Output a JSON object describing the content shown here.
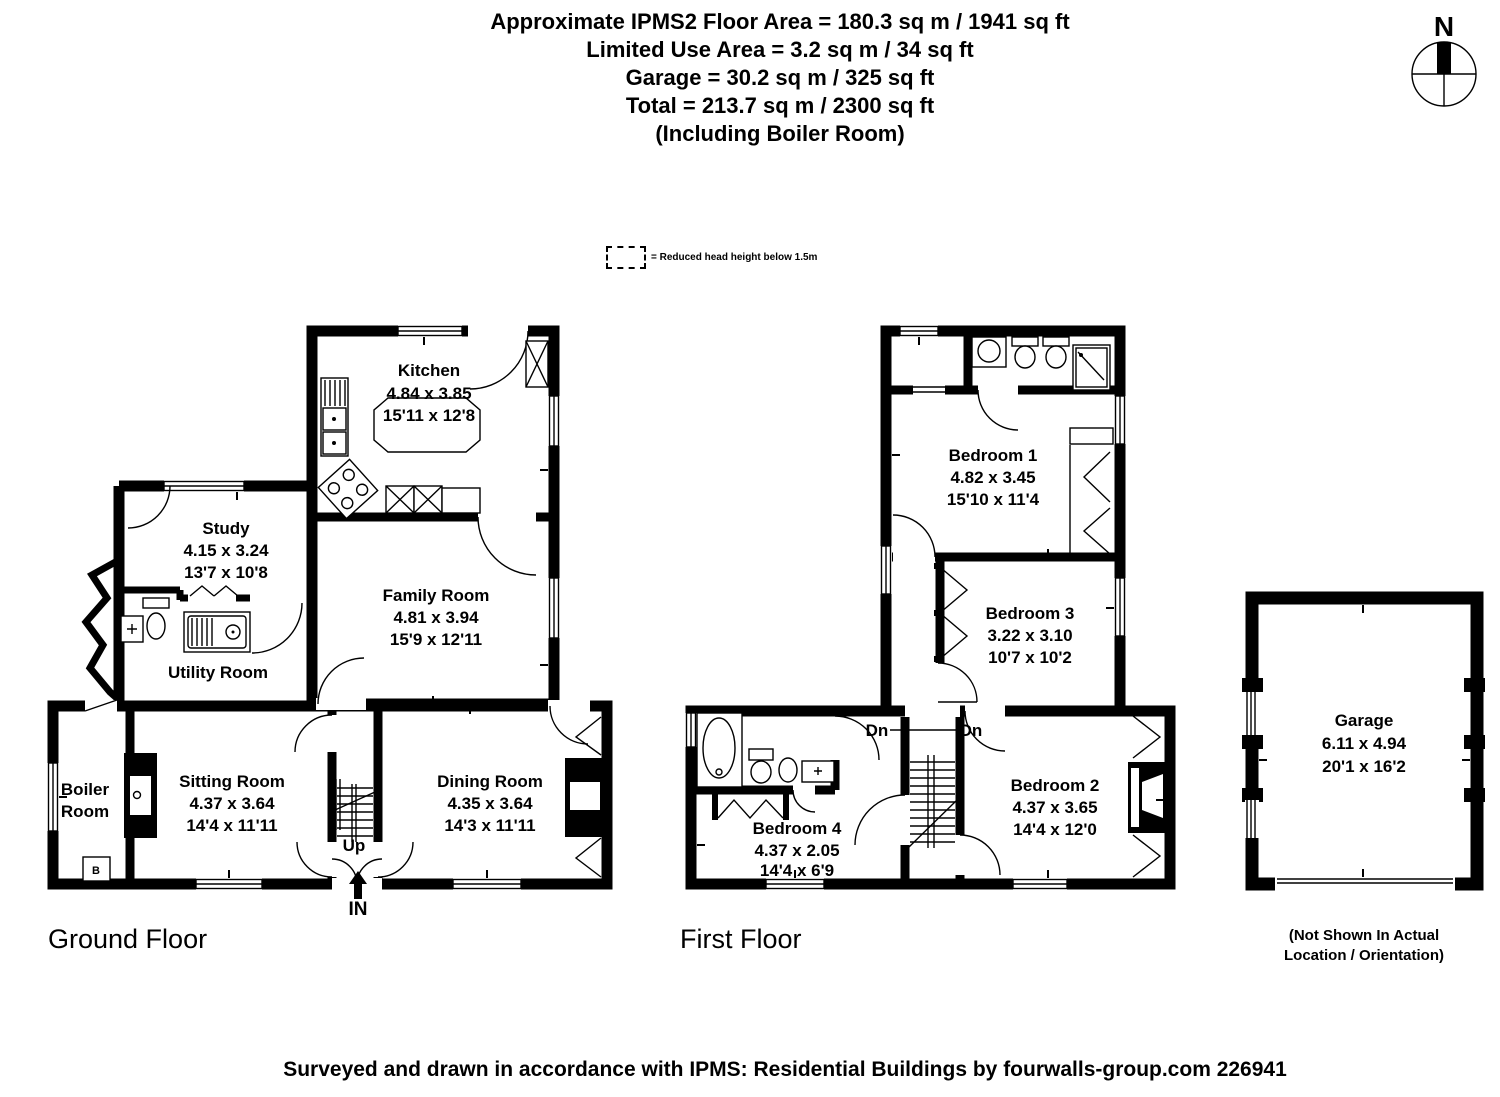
{
  "header": {
    "lines": [
      "Approximate IPMS2 Floor Area = 180.3 sq m / 1941 sq ft",
      "Limited Use Area = 3.2 sq m / 34 sq ft",
      "Garage = 30.2 sq m / 325 sq ft",
      "Total = 213.7 sq m / 2300 sq ft",
      "(Including Boiler Room)"
    ]
  },
  "legend": {
    "label": "= Reduced head height below 1.5m"
  },
  "compass": {
    "north_label": "N"
  },
  "ground_floor": {
    "caption": "Ground Floor",
    "stairs_label": "Up",
    "entrance_label": "IN",
    "rooms": {
      "kitchen": {
        "name": "Kitchen",
        "metric": "4.84 x 3.85",
        "imperial": "15'11 x 12'8"
      },
      "study": {
        "name": "Study",
        "metric": "4.15 x 3.24",
        "imperial": "13'7 x 10'8"
      },
      "family_room": {
        "name": "Family Room",
        "metric": "4.81 x 3.94",
        "imperial": "15'9 x 12'11"
      },
      "utility_room": {
        "name": "Utility Room"
      },
      "boiler_room": {
        "name_line1": "Boiler",
        "name_line2": "Room",
        "boiler_label": "B"
      },
      "sitting_room": {
        "name": "Sitting Room",
        "metric": "4.37 x 3.64",
        "imperial": "14'4 x 11'11"
      },
      "dining_room": {
        "name": "Dining Room",
        "metric": "4.35 x 3.64",
        "imperial": "14'3 x 11'11"
      }
    }
  },
  "first_floor": {
    "caption": "First Floor",
    "stairs_labels": [
      "Dn",
      "Dn"
    ],
    "rooms": {
      "bedroom_1": {
        "name": "Bedroom 1",
        "metric": "4.82 x 3.45",
        "imperial": "15'10 x 11'4"
      },
      "bedroom_2": {
        "name": "Bedroom 2",
        "metric": "4.37 x 3.65",
        "imperial": "14'4 x 12'0"
      },
      "bedroom_3": {
        "name": "Bedroom 3",
        "metric": "3.22 x 3.10",
        "imperial": "10'7 x 10'2"
      },
      "bedroom_4": {
        "name": "Bedroom 4",
        "metric": "4.37 x 2.05",
        "imperial": "14'4 x 6'9"
      }
    }
  },
  "garage": {
    "name": "Garage",
    "metric": "6.11 x 4.94",
    "imperial": "20'1 x 16'2",
    "note_line1": "(Not Shown In Actual",
    "note_line2": "Location / Orientation)"
  },
  "footer": {
    "text": "Surveyed and drawn in accordance with IPMS: Residential Buildings by fourwalls-group.com 226941"
  }
}
